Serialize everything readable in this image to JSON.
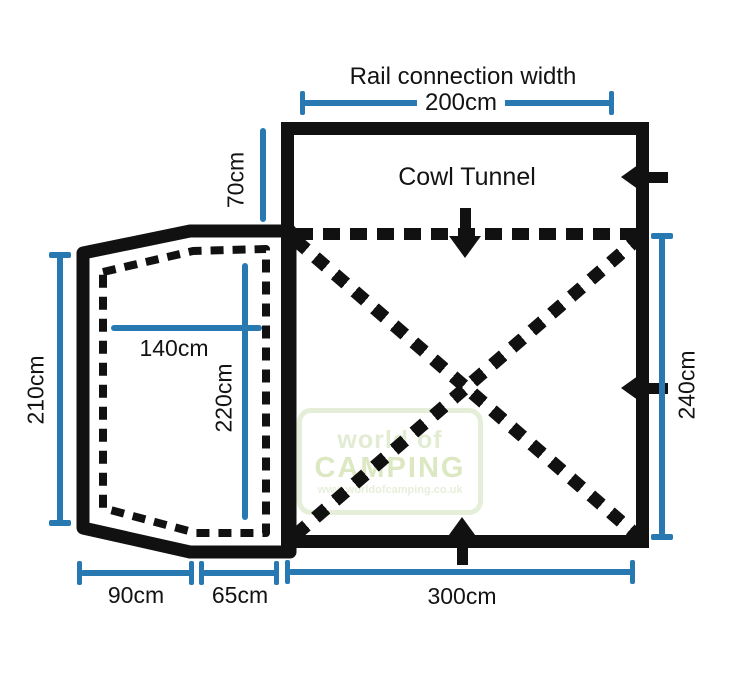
{
  "diagram": {
    "title": "Rail connection width",
    "cowl_label": "Cowl Tunnel",
    "dimensions": {
      "rail_width": "200cm",
      "tunnel_depth": "70cm",
      "annex_outer_height": "210cm",
      "annex_inner_width": "140cm",
      "annex_inner_height": "220cm",
      "main_height": "240cm",
      "annex_front_width": "90cm",
      "annex_side_width": "65cm",
      "main_width": "300cm"
    },
    "watermark": {
      "line1": "world of",
      "line2": "CAMPING",
      "line3": "www.worldofcamping.co.uk"
    },
    "colors": {
      "dimension_blue": "#2878b2",
      "outline_black": "#111111",
      "watermark_green": "#dce8c2"
    }
  }
}
